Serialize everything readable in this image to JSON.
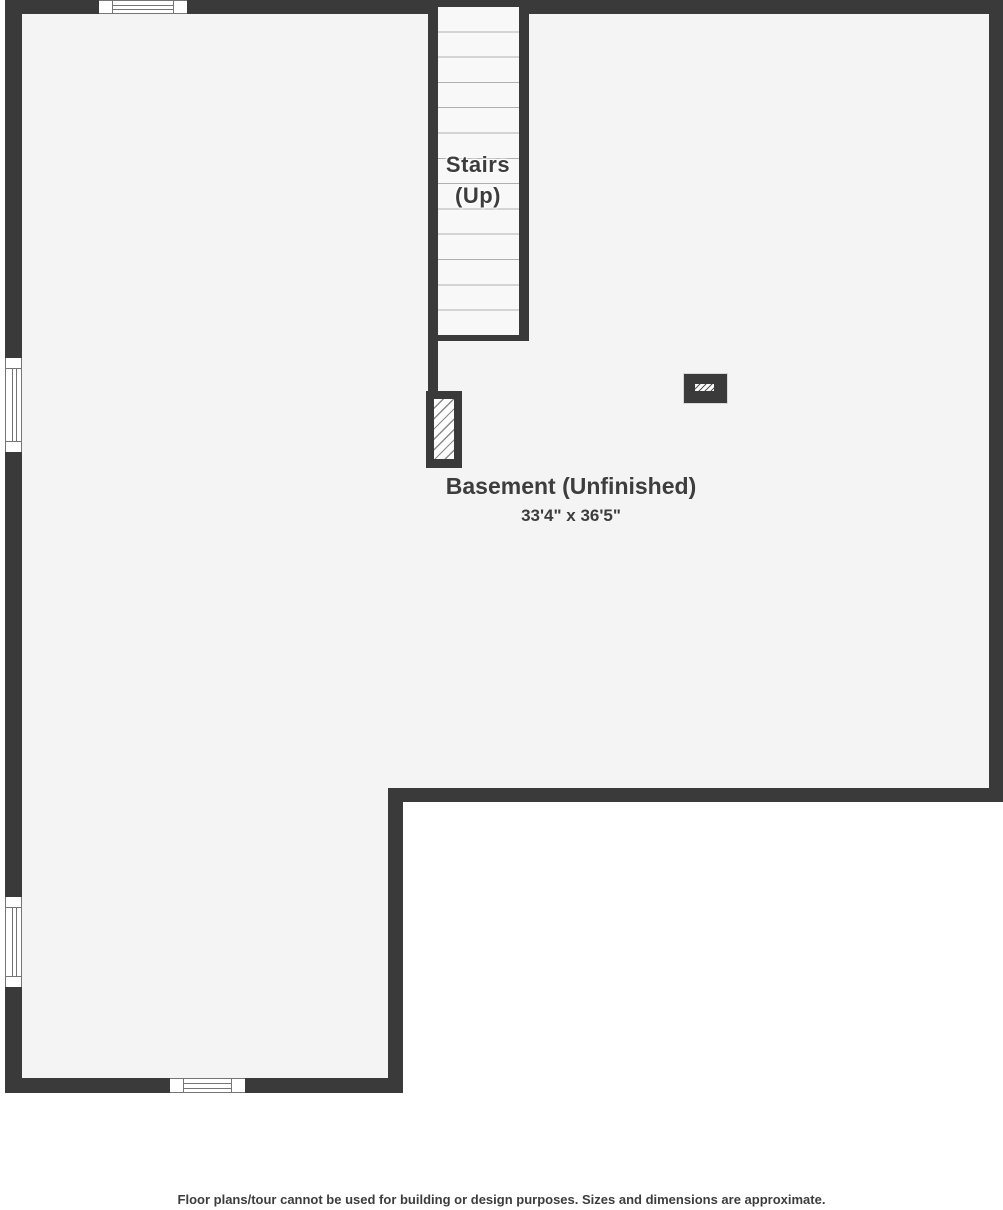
{
  "floorplan": {
    "stairs": {
      "line1": "Stairs",
      "line2": "(Up)"
    },
    "room": {
      "name": "Basement (Unfinished)",
      "dimensions": "33'4\" x 36'5\""
    },
    "footer": "Floor plans/tour cannot be used for building or design purposes. Sizes and dimensions are approximate."
  },
  "colors": {
    "wall": "#3a3a3a",
    "floor": "#f4f4f4",
    "outside": "#ffffff",
    "stair_tread_line": "#b0b0b0",
    "window_frame_line": "#757575",
    "text": "#3d3d3d"
  }
}
